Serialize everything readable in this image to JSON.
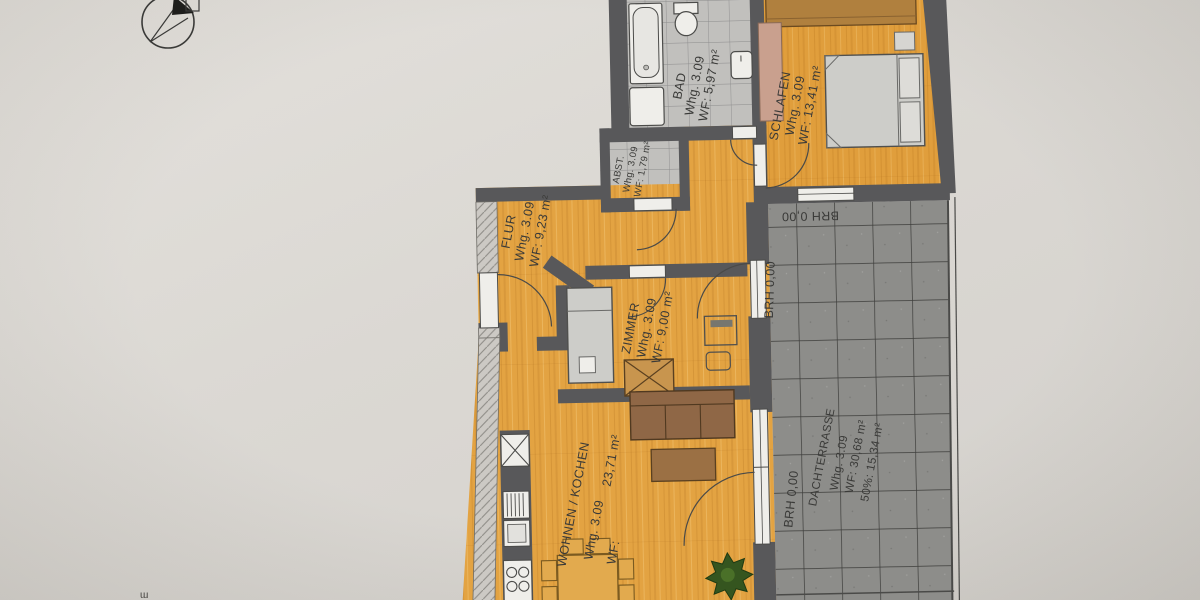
{
  "plan": {
    "unit_number": "Whg. 3.09",
    "rooms": [
      {
        "id": "bad",
        "name": "BAD",
        "unit": "Whg. 3.09",
        "area": "WF: 5,97 m²"
      },
      {
        "id": "schlafen",
        "name": "SCHLAFEN",
        "unit": "Whg. 3.09",
        "area": "WF: 13,41 m²"
      },
      {
        "id": "abstellraum",
        "name": "ABST.",
        "unit": "Whg. 3.09",
        "area": "WF: 1,79 m²"
      },
      {
        "id": "flur",
        "name": "FLUR",
        "unit": "Whg. 3.09",
        "area": "WF: 9,23 m²"
      },
      {
        "id": "zimmer",
        "name": "ZIMMER",
        "unit": "Whg. 3.09",
        "area": "WF: 9,00 m²"
      },
      {
        "id": "wohnen",
        "name": "WOHNEN / KOCHEN",
        "unit": "Whg. 3.09",
        "area_label": "WF:",
        "area_value": "23,71 m²"
      },
      {
        "id": "dachterrasse",
        "name": "DACHTERRASSE",
        "unit": "Whg. 3.09",
        "area": "WF: 30,68 m²",
        "area_half": "50%: 15,34 m²"
      }
    ],
    "annotations": {
      "brh_top": "BRH 0,00",
      "brh_side_zimmer": "BRH 0,00",
      "brh_side_wohnen": "BRH 0,00"
    },
    "misc": {
      "corner_fragment": "ɯ"
    },
    "colors": {
      "floor_orange": "#e3a342",
      "wall_gray": "#58585a",
      "tile_gray": "#c1c0bd",
      "terrace_gray": "#8d8d8a",
      "fixture_white": "#efeeea",
      "sofa_brown": "#8f6746",
      "plant_green": "#35551f"
    }
  }
}
